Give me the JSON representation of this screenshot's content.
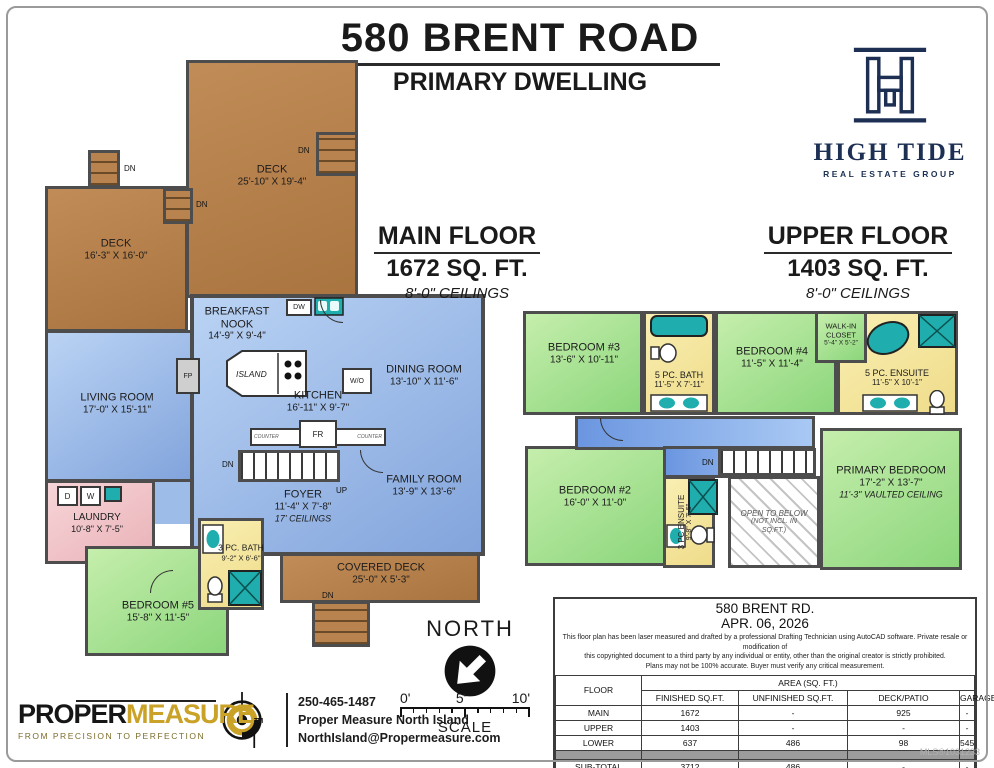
{
  "header": {
    "title": "580 BRENT ROAD",
    "subtitle": "PRIMARY DWELLING"
  },
  "brand_logo": {
    "name": "HIGH TIDE",
    "tagline": "REAL ESTATE GROUP"
  },
  "main_floor": {
    "heading": "MAIN FLOOR",
    "sqft": "1672 SQ. FT.",
    "ceilings": "8'-0\" CEILINGS",
    "rooms": [
      {
        "name": "DECK",
        "dims": "25'-10\" X 19'-4\""
      },
      {
        "name": "DECK",
        "dims": "16'-3\" X 16'-0\""
      },
      {
        "name": "LIVING ROOM",
        "dims": "17'-0\" X 15'-11\""
      },
      {
        "name": "BREAKFAST NOOK",
        "dims": "14'-9\" X 9'-4\""
      },
      {
        "name": "KITCHEN",
        "dims": "16'-11\" X 9'-7\""
      },
      {
        "name": "DINING ROOM",
        "dims": "13'-10\" X 11'-6\""
      },
      {
        "name": "FAMILY ROOM",
        "dims": "13'-9\" X 13'-6\""
      },
      {
        "name": "FOYER",
        "dims": "11'-4\" X 7'-8\"",
        "note": "17' CEILINGS"
      },
      {
        "name": "LAUNDRY",
        "dims": "10'-8\" X 7'-5\""
      },
      {
        "name": "BEDROOM #5",
        "dims": "15'-8\" X 11'-5\""
      },
      {
        "name": "3 PC. BATH",
        "dims": "9'-2\" X 6'-6\""
      },
      {
        "name": "COVERED DECK",
        "dims": "25'-0\" X 5'-3\""
      }
    ]
  },
  "upper_floor": {
    "heading": "UPPER FLOOR",
    "sqft": "1403 SQ. FT.",
    "ceilings": "8'-0\" CEILINGS",
    "rooms": [
      {
        "name": "BEDROOM #3",
        "dims": "13'-6\" X 10'-11\""
      },
      {
        "name": "5 PC. BATH",
        "dims": "11'-5\" X 7'-11\""
      },
      {
        "name": "BEDROOM #4",
        "dims": "11'-5\" X 11'-4\""
      },
      {
        "name": "WALK-IN CLOSET",
        "dims": "5'-4\" X 5'-2\""
      },
      {
        "name": "5 PC. ENSUITE",
        "dims": "11'-5\" X 10'-1\""
      },
      {
        "name": "BEDROOM #2",
        "dims": "16'-0\" X 11'-0\""
      },
      {
        "name": "3 PC ENSUITE",
        "dims": "9'-8\" X 7'-5\""
      },
      {
        "name": "OPEN TO BELOW",
        "note": "(NOT INCL. IN SQ.FT.)"
      },
      {
        "name": "PRIMARY BEDROOM",
        "dims": "17'-2\" X 13'-7\"",
        "note": "11'-3\" VAULTED CEILING"
      }
    ]
  },
  "fixtures": {
    "fp": "FP",
    "dw": "DW",
    "wo": "W/O",
    "fr": "FR",
    "counter": "COUNTER",
    "island": "ISLAND",
    "dryer": "D",
    "washer": "W",
    "dn": "DN",
    "up": "UP"
  },
  "compass": {
    "label": "NORTH"
  },
  "scale_bar": {
    "tick0": "0'",
    "tick5": "5'",
    "tick10": "10'",
    "label": "SCALE"
  },
  "vendor": {
    "logo_black": "PROPER",
    "logo_gold": "MEASURE",
    "tm": "TM",
    "tagline": "FROM PRECISION TO PERFECTION",
    "phone": "250-465-1487",
    "company": "Proper Measure North Island",
    "email": "NorthIsland@Propermeasure.com"
  },
  "info_table": {
    "address": "580 BRENT RD.",
    "date": "APR. 06, 2026",
    "disclaimer1": "This floor plan has been laser measured and drafted by a professional Drafting Technician using AutoCAD software. Private resale or modification of",
    "disclaimer2": "this copyrighted document to a third party by any individual or entity, other than the original creator is strictly prohibited.",
    "disclaimer3": "Plans may not be 100% accurate.  Buyer must verify any critical measurement.",
    "floor_col": "FLOOR",
    "area_header": "AREA (SQ. FT.)",
    "col1": "FINISHED SQ.FT.",
    "col2": "UNFINISHED SQ.FT.",
    "col3": "DECK/PATIO",
    "col4": "GARAGE",
    "rows": [
      {
        "floor": "MAIN",
        "c1": "1672",
        "c2": "-",
        "c3": "925",
        "c4": "-"
      },
      {
        "floor": "UPPER",
        "c1": "1403",
        "c2": "-",
        "c3": "-",
        "c4": "-"
      },
      {
        "floor": "LOWER",
        "c1": "637",
        "c2": "486",
        "c3": "98",
        "c4": "545"
      }
    ],
    "subtotal": {
      "floor": "SUB-TOTAL",
      "c1": "3712",
      "c2": "486",
      "c3": "-",
      "c4": "-"
    },
    "total": {
      "floor": "TOTAL",
      "c12": "4198",
      "c3": "1023",
      "c4": "545"
    }
  },
  "mls": "MLS®1031233"
}
